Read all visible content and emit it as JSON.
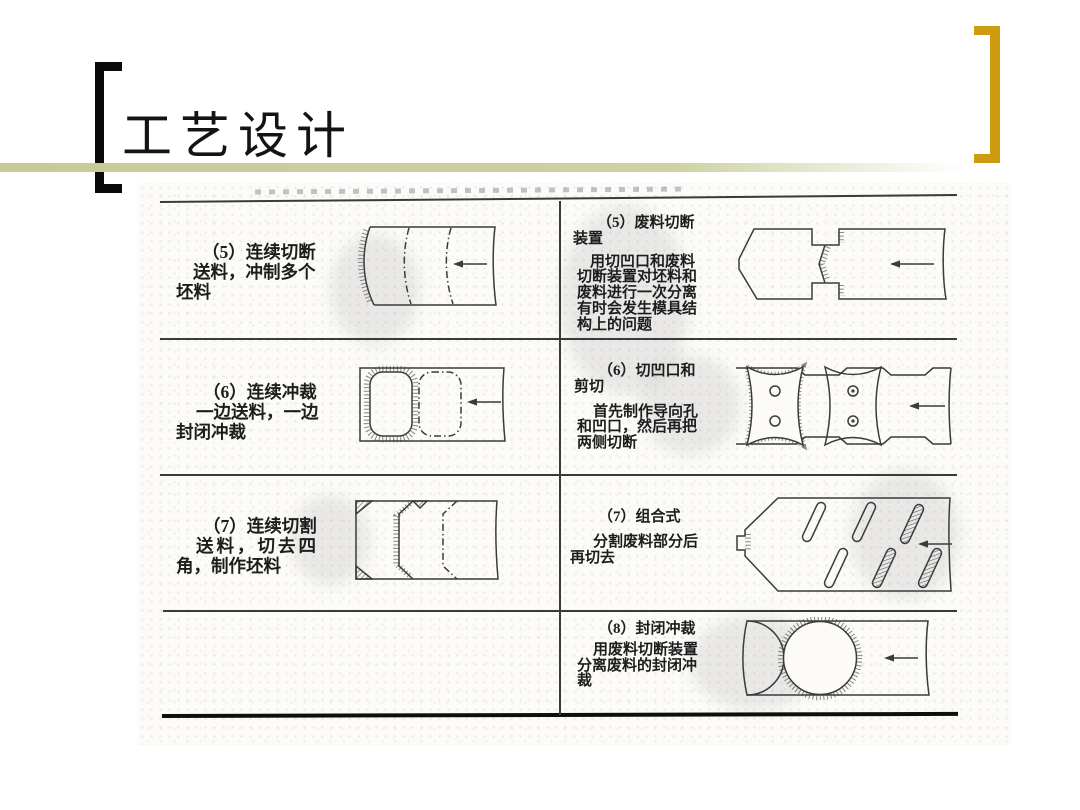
{
  "slide": {
    "title": "工艺设计"
  },
  "decorations": {
    "gold_color": "#ce9b11",
    "olive_line_color": "#ced2a4",
    "left_bracket_icon": "black-open-bracket",
    "right_bracket_icon": "gold-close-bracket"
  },
  "table": {
    "rows": [
      {
        "left": {
          "diagram": "strip-with-curved-shear-lines",
          "lines": [
            "（5）连续切断",
            "送料，冲制多个",
            "坯料"
          ]
        },
        "right": {
          "diagram": "blank-with-scrap-cutoff-device",
          "lines": [
            "（5）废料切断",
            "装置",
            "用切凹口和废料",
            "切断装置对坯料和",
            "废料进行一次分离",
            "有时会发生模具结",
            "构上的问题"
          ]
        }
      },
      {
        "left": {
          "diagram": "strip-with-rounded-rectangle-blanks",
          "lines": [
            "（6）连续冲裁",
            "一边送料，一边",
            "封闭冲裁"
          ]
        },
        "right": {
          "diagram": "notched-strip-with-pilot-holes",
          "lines": [
            "（6）切凹口和",
            "剪切",
            "首先制作导向孔",
            "和凹口，然后再把",
            "两侧切断"
          ]
        }
      },
      {
        "left": {
          "diagram": "strip-with-corner-cut-blanks",
          "lines": [
            "（7）连续切割",
            "送料，切去四",
            "角，制作坯料"
          ]
        },
        "right": {
          "diagram": "strip-with-angled-slots",
          "lines": [
            "（7）组合式",
            "分割废料部分后",
            "再切去"
          ]
        }
      },
      {
        "left": {
          "diagram": "",
          "lines": []
        },
        "right": {
          "diagram": "strip-with-closed-circle-blank",
          "lines": [
            "（8）封闭冲裁",
            "用废料切断装置",
            "分离废料的封闭冲",
            "裁"
          ]
        }
      }
    ]
  }
}
